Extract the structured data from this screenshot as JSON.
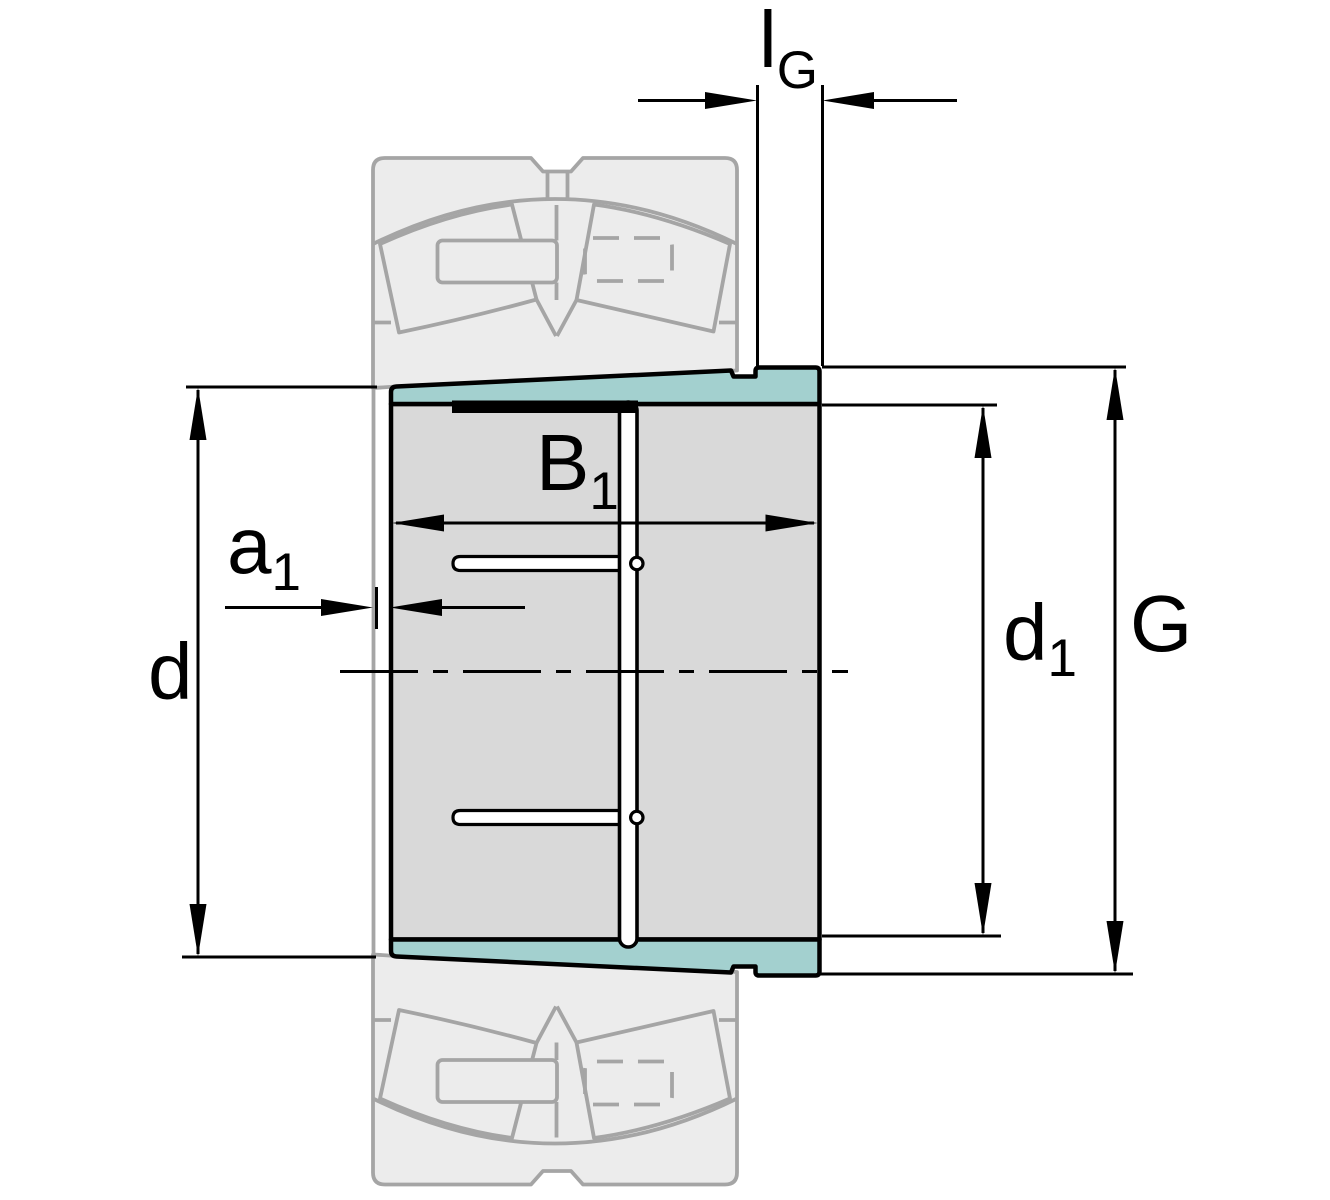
{
  "diagram": {
    "labels": {
      "bore_diameter": {
        "main": "d"
      },
      "offset_a1": {
        "main": "a",
        "sub": "1"
      },
      "sleeve_width_b1": {
        "main": "B",
        "sub": "1"
      },
      "thread_length_lg": {
        "main": "l",
        "sub": "G"
      },
      "diameter_d1": {
        "main": "d",
        "sub": "1"
      },
      "thread_g": {
        "main": "G"
      }
    },
    "colors": {
      "sleeve_highlight": "#A3D0CF",
      "sleeve_body": "#D9D9D9",
      "bearing_ghost_fill": "#ECECEC",
      "bearing_ghost_line": "#A5A5A5",
      "outline": "#000000",
      "background": "#FFFFFF"
    }
  }
}
